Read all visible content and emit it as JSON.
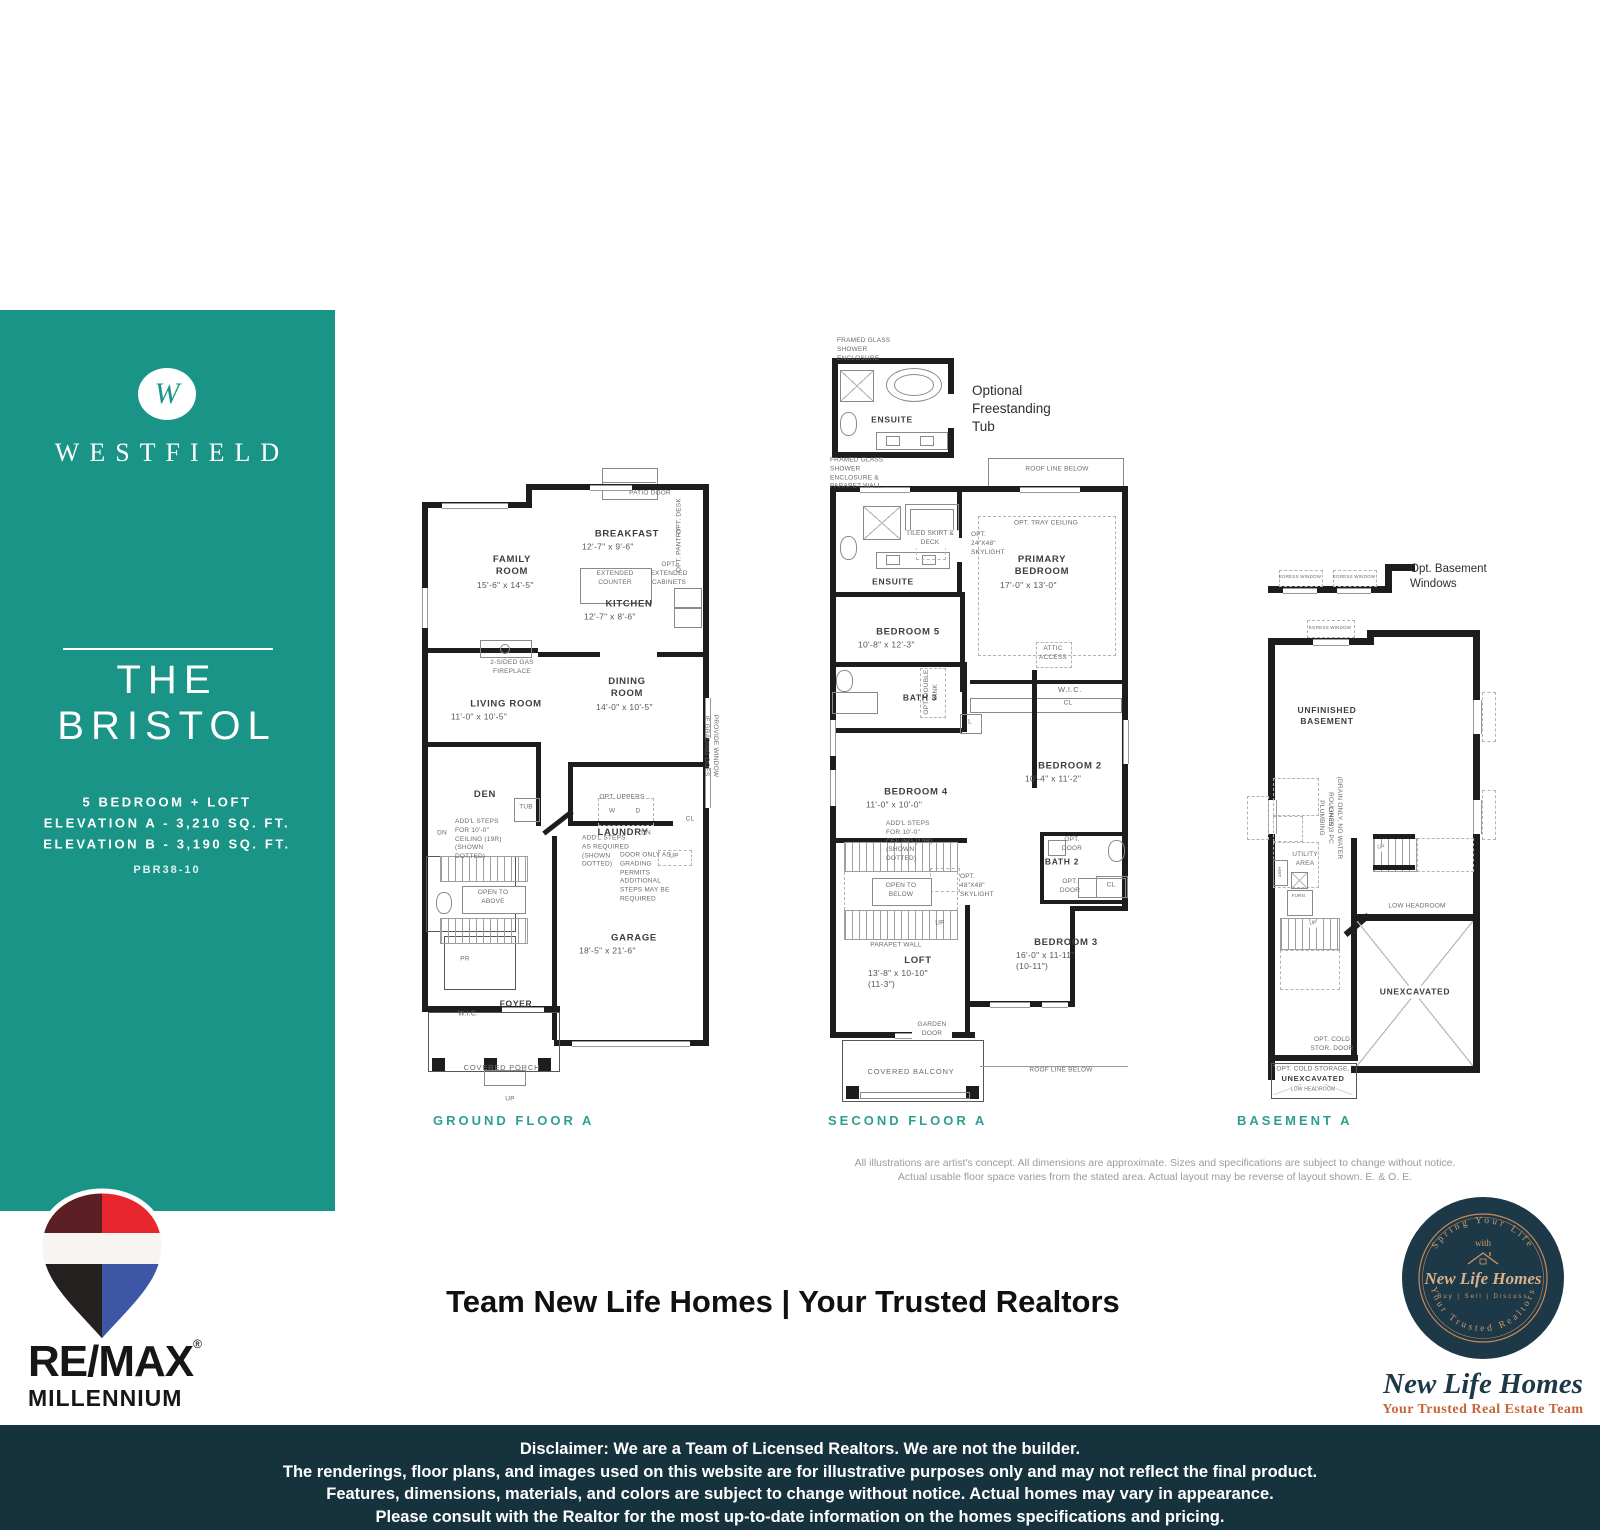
{
  "colors": {
    "teal": "#1b9488",
    "plan_label_teal": "#2f9e92",
    "bottom_bar": "#15323d",
    "remax_red": "#e8262d",
    "remax_maroon": "#5b1f24",
    "remax_blue": "#3d56a5",
    "remax_black": "#23201f",
    "badge_navy": "#1d3947",
    "badge_copper": "#c98a5e"
  },
  "sidebar": {
    "monogram": "W",
    "brand": "WESTFIELD",
    "title_line1": "THE",
    "title_line2": "BRISTOL",
    "spec_line1": "5 BEDROOM + LOFT",
    "spec_line2": "ELEVATION A - 3,210 SQ. FT.",
    "spec_line3": "ELEVATION B - 3,190 SQ. FT.",
    "plan_code": "PBR38-10"
  },
  "plans": {
    "ground": {
      "label": "GROUND FLOOR A",
      "rooms": {
        "family": {
          "name": "FAMILY ROOM",
          "dims": "15'-6\" x 14'-5\""
        },
        "breakfast": {
          "name": "BREAKFAST",
          "dims": "12'-7\" x 9'-6\""
        },
        "kitchen": {
          "name": "KITCHEN",
          "dims": "12'-7\" x 8'-6\""
        },
        "living": {
          "name": "LIVING ROOM",
          "dims": "11'-0\" x 10'-5\""
        },
        "dining": {
          "name": "DINING ROOM",
          "dims": "14'-0\" x 10'-5\""
        },
        "den": {
          "name": "DEN"
        },
        "laundry": {
          "name": "LAUNDRY"
        },
        "garage": {
          "name": "GARAGE",
          "dims": "18'-5\" x 21'-6\""
        },
        "pr": {
          "name": "PR"
        },
        "foyer": {
          "name": "FOYER"
        },
        "wic": {
          "name": "W.I.C."
        },
        "porch": {
          "name": "COVERED PORCH"
        }
      },
      "notes": {
        "patio_door": "PATIO DOOR",
        "extended_counter": "EXTENDED COUNTER",
        "opt_cabinets": "OPT. EXTENDED CABINETS",
        "opt_desk": "OPT. DESK",
        "opt_pantry": "OPT. PANTRY",
        "fireplace": "2-SIDED GAS FIREPLACE",
        "addl_steps": "ADD'L STEPS FOR 10'-0\" CEILING (19R) (SHOWN DOTTED)",
        "addl_steps_req": "ADD'L STEPS AS REQUIRED (SHOWN DOTTED)",
        "open_above": "OPEN TO ABOVE",
        "door_grading": "DOOR ONLY AS GRADING PERMITS ADDITIONAL STEPS MAY BE REQUIRED",
        "provide_window": "PROVIDE WINDOW IF GRADING DOES",
        "tub": "TUB",
        "washer": "W",
        "dryer": "D",
        "opt_uppers": "OPT. UPPERS",
        "up": "UP",
        "dn": "DN",
        "cl": "CL"
      }
    },
    "second": {
      "label": "SECOND FLOOR A",
      "optional_tub": "Optional Freestanding Tub",
      "rooms": {
        "ensuite": {
          "name": "ENSUITE"
        },
        "primary": {
          "name": "PRIMARY BEDROOM",
          "dims": "17'-0\" x 13'-0\""
        },
        "bed5": {
          "name": "BEDROOM 5",
          "dims": "10'-8\" x 12'-3\""
        },
        "bed4": {
          "name": "BEDROOM 4",
          "dims": "11'-0\" x 10'-0\""
        },
        "bed2": {
          "name": "BEDROOM 2",
          "dims": "10'-4\" x 11'-2\""
        },
        "bed3": {
          "name": "BEDROOM 3",
          "dims": "16'-0\" x 11-11\"",
          "dims2": "(10-11\")"
        },
        "bath3": {
          "name": "BATH 3"
        },
        "bath2": {
          "name": "BATH 2"
        },
        "loft": {
          "name": "LOFT",
          "dims": "13'-8\" x 10-10\"",
          "dims2": "(11-3\")"
        },
        "wic": {
          "name": "W.I.C."
        },
        "balcony": {
          "name": "COVERED BALCONY"
        }
      },
      "notes": {
        "framed_glass": "FRAMED GLASS SHOWER ENCLOSURE",
        "framed_glass_parapet": "FRAMED GLASS SHOWER ENCLOSURE & PARAPET WALL",
        "roof_line": "ROOF LINE BELOW",
        "tray": "OPT. TRAY CEILING",
        "skylight24": "OPT. 24\"X48\" SKYLIGHT",
        "skylight48": "OPT. 48\"X48\" SKYLIGHT",
        "tiled_skirt": "TILED SKIRT & DECK",
        "attic": "ATTIC ACCESS",
        "open_below": "OPEN TO BELOW",
        "parapet": "PARAPET WALL",
        "garden_door": "GARDEN DOOR",
        "opt_door": "OPT. DOOR",
        "opt_double_sink": "OPT. DOUBLE SINK",
        "addl_steps": "ADD'L STEPS FOR 10'-0\" CEILING (19R) (SHOWN DOTTED)",
        "cl": "CL",
        "linen": "L",
        "up": "UP"
      }
    },
    "basement": {
      "label": "BASEMENT A",
      "opt_windows": "Opt. Basement Windows",
      "egress": "EGRESS WINDOW",
      "unfinished": "UNFINISHED BASEMENT",
      "utility": "UTILITY AREA",
      "unexcavated": "UNEXCAVATED",
      "low_headroom": "LOW HEADROOM",
      "cold_door": "OPT. COLD STOR. DOOR",
      "cold_storage": "OPT. COLD STORAGE,",
      "furn": "FURN.",
      "hwt": "HWT",
      "rough_in": "ROUGH-IN 3 PC PLUMBING",
      "rough_in2": "(DRAIN ONLY, NO WATER LINES)",
      "up": "UP"
    }
  },
  "fine_print": {
    "line1": "All illustrations are artist's concept. All dimensions are approximate. Sizes and specifications are subject to change without notice.",
    "line2": "Actual usable floor space varies from the stated area. Actual layout may be reverse of layout shown. E. & O. E."
  },
  "footer": {
    "remax": {
      "name": "RE/MAX",
      "registered": "®",
      "sub": "MILLENNIUM"
    },
    "team_banner": "Team New Life Homes | Your Trusted Realtors",
    "badge": {
      "arc_top": "Spring Your Life",
      "with_word": "with",
      "name": "New Life Homes",
      "services": "Buy | Sell | Discuss",
      "arc_bottom": "Your Trusted Realtors",
      "script_name": "New Life Homes",
      "script_tagline": "Your Trusted Real Estate Team"
    },
    "disclaimer": {
      "line1": "Disclaimer: We are a Team of Licensed Realtors. We are not the builder.",
      "line2": "The renderings, floor plans, and images used on this website are for illustrative purposes only and may not reflect the final product.",
      "line3": "Features, dimensions, materials, and colors are subject to change without notice. Actual homes may vary in appearance.",
      "line4": "Please consult with the Realtor for the most up-to-date information on the homes specifications and pricing."
    }
  }
}
